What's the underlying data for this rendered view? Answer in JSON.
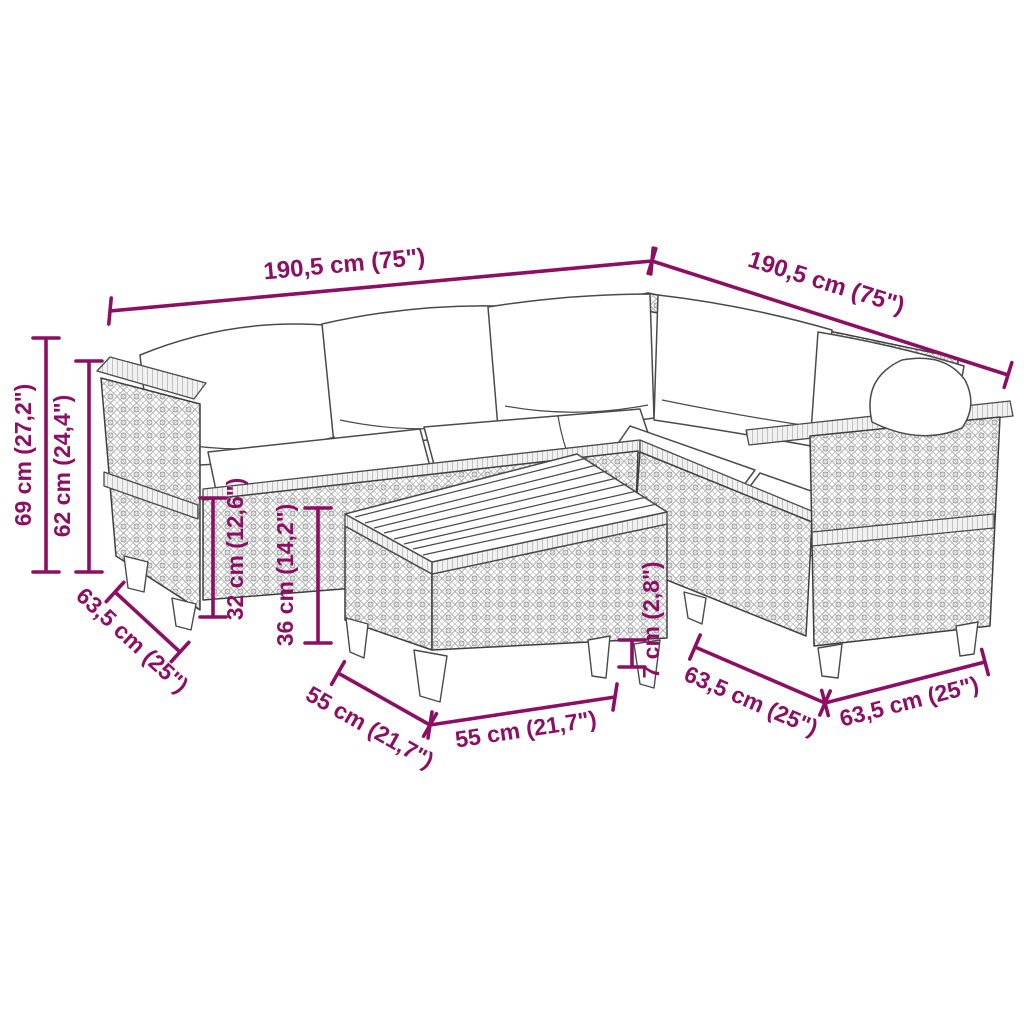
{
  "diagram": {
    "accent_color": "#8c0f63",
    "line_art_color": "#4a4a4a",
    "background_color": "#ffffff",
    "subject": "corner sofa set with coffee table dimension drawing",
    "dimensions": {
      "overall_width_left": "190,5 cm (75\")",
      "overall_width_right": "190,5 cm (75\")",
      "total_height": "69 cm (27,2\")",
      "back_height": "62 cm (24,4\")",
      "seat_height": "32 cm (12,6\")",
      "table_height": "36 cm (14,2\")",
      "sofa_depth_left": "63,5 cm (25\")",
      "table_depth": "55 cm (21,7\")",
      "table_width": "55 cm (21,7\")",
      "leg_height": "7 cm (2,8\")",
      "sofa_depth_middle": "63,5 cm (25\")",
      "sofa_depth_right": "63,5 cm (25\")"
    }
  }
}
